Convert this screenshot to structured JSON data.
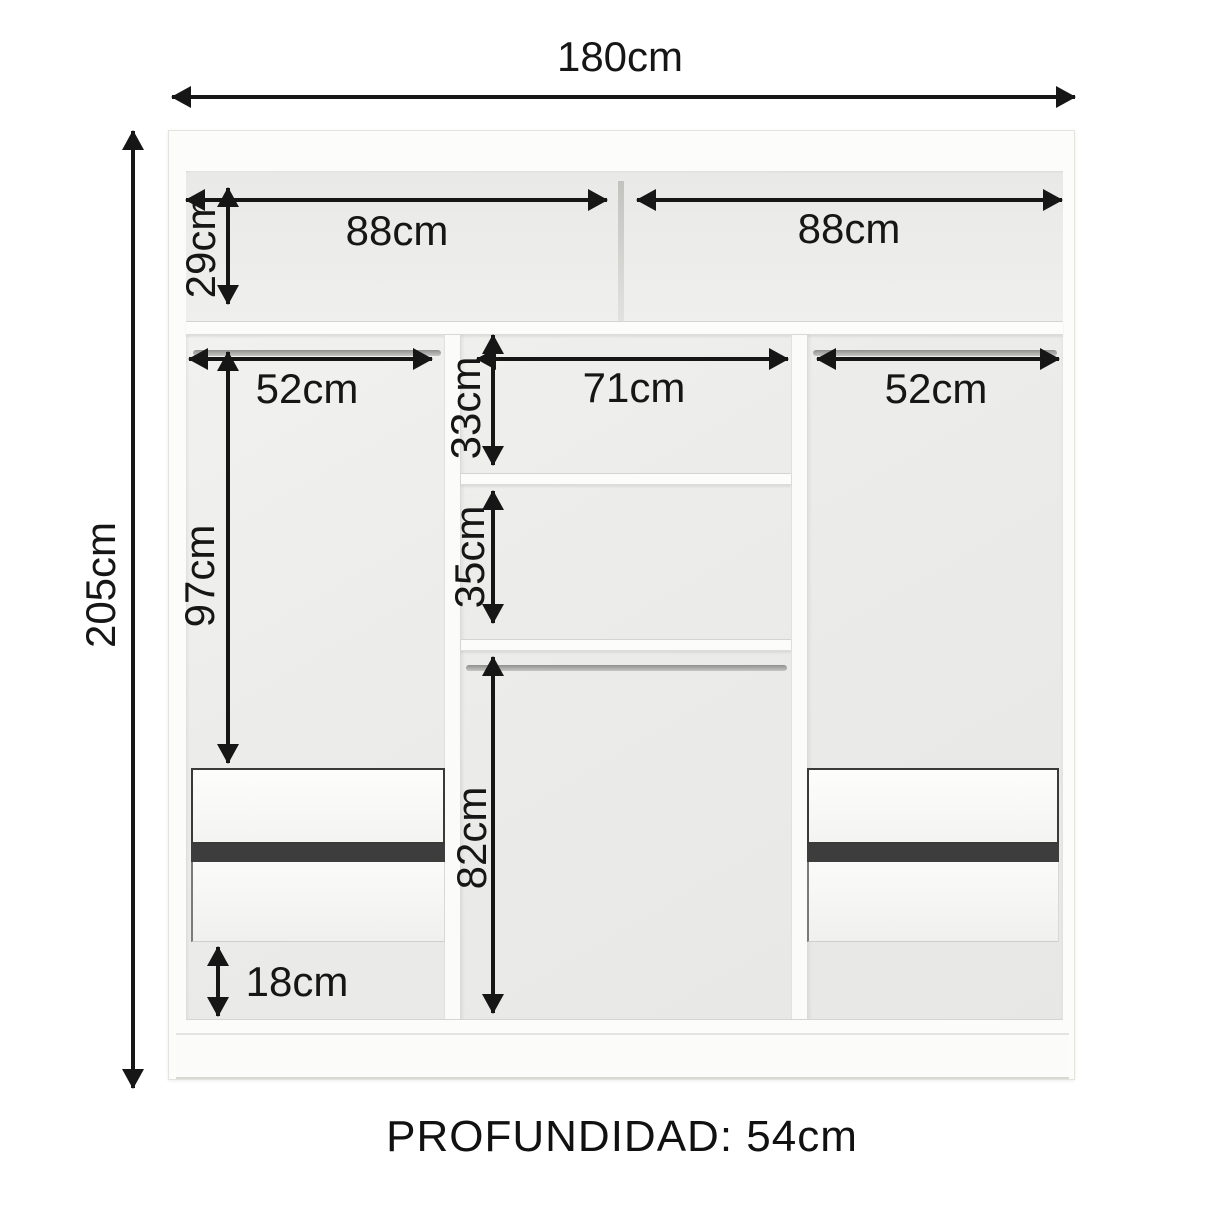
{
  "dims": {
    "width": "180cm",
    "height": "205cm",
    "top_left": "88cm",
    "top_right": "88cm",
    "top_height": "29cm",
    "left_rod": "52cm",
    "center_width": "71cm",
    "right_rod": "52cm",
    "shelf_gap_top": "33cm",
    "shelf_gap_mid": "35cm",
    "left_height": "97cm",
    "center_height": "82cm",
    "bottom_gap": "18cm"
  },
  "footer": {
    "depth": "PROFUNDIDAD: 54cm"
  },
  "colors": {
    "arrow": "#161616",
    "text": "#161616",
    "drawer_gap": "#3d3d3d",
    "rod": "#a5a5a3",
    "panel": "#fbfbfa",
    "back_wall": "#ececea",
    "background": "#ffffff"
  }
}
